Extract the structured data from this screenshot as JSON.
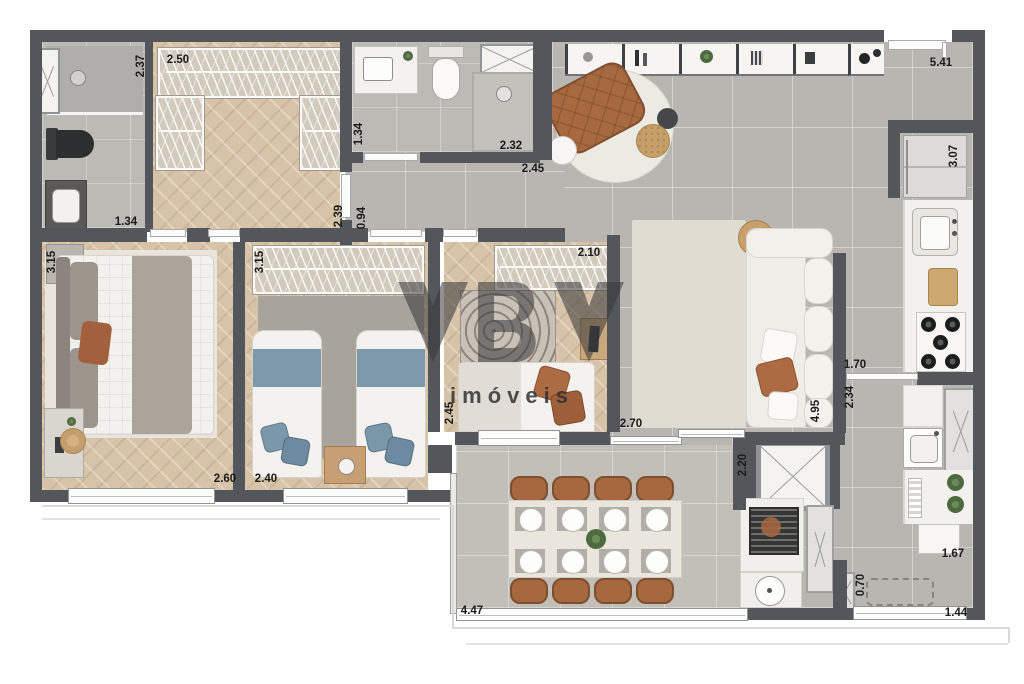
{
  "watermark": {
    "brand": "YBY",
    "subtitle": "imóveis"
  },
  "dims": {
    "closet_depth": "2.37",
    "closet_front": "2.50",
    "bath1_width": "1.34",
    "master_length": "3.15",
    "master_width": "2.60",
    "bath2_side": "1.34",
    "bath2_shower": "2.32",
    "hall_width": "2.45",
    "corridor_length": "2.39",
    "corridor_width": "0.94",
    "bed2_length": "3.15",
    "bed2_width": "2.40",
    "bed3_side": "2.45",
    "bed3_wardrobe": "2.10",
    "bed3_width": "2.70",
    "living_top": "5.41",
    "kitchen_fridge_wall": "3.07",
    "kitchen_pass": "1.70",
    "kitchen_depth": "2.34",
    "living_length": "4.95",
    "balcony_depth": "2.20",
    "balcony_width": "4.47",
    "service_counter": "1.67",
    "bench_depth": "0.70",
    "service_width": "1.44"
  },
  "colors": {
    "wall": "#53575b",
    "wood_floor": "#d7c3a7",
    "tile_floor": "#b9b6b1",
    "accent_blue": "#7d99aa",
    "accent_terracotta": "#ad6b44",
    "counter_white": "#f3f1ed"
  }
}
